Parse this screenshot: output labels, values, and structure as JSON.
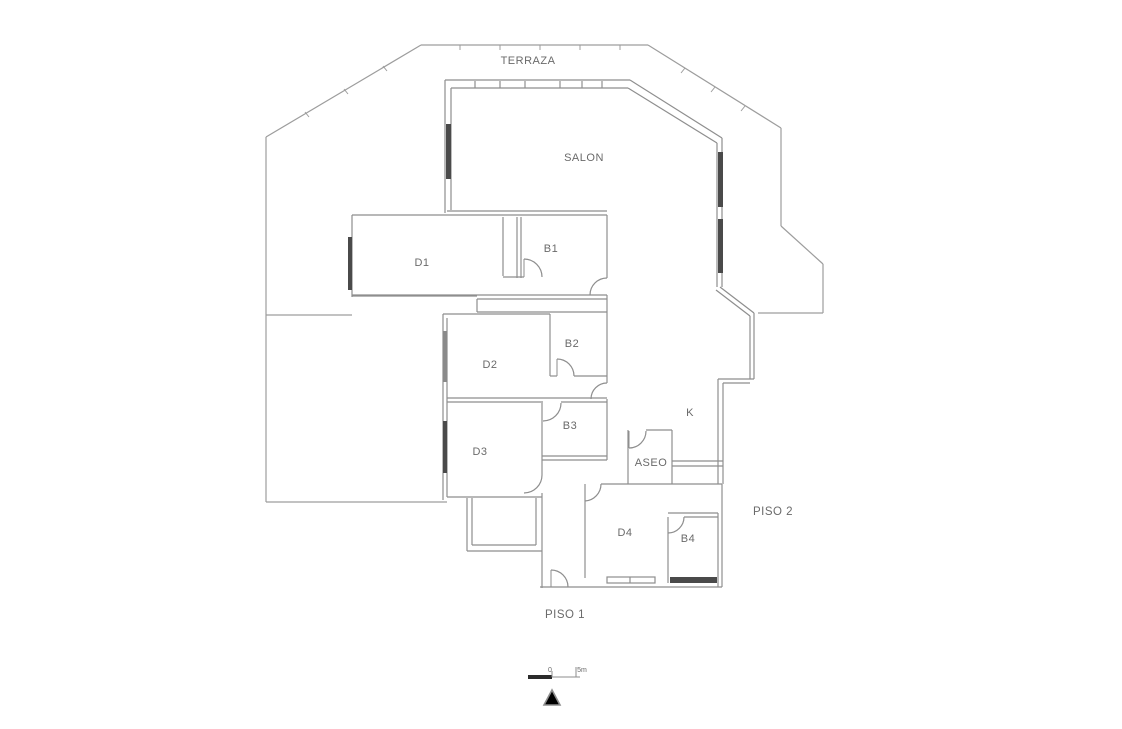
{
  "rooms": {
    "terraza": "TERRAZA",
    "salon": "SALON",
    "d1": "D1",
    "b1": "B1",
    "d2": "D2",
    "b2": "B2",
    "d3": "D3",
    "b3": "B3",
    "k": "K",
    "aseo": "ASEO",
    "d4": "D4",
    "b4": "B4"
  },
  "floors": {
    "piso1": "PISO 1",
    "piso2": "PISO 2"
  },
  "scale_bar": {
    "start_label": "0",
    "end_label": "5m"
  },
  "icons": {
    "north_arrow": "triangle-outline"
  },
  "colors": {
    "background": "#ffffff",
    "wall_line": "#8e8e8e",
    "terrace_line": "#9d9d9d",
    "window_fill": "#4a4a4a",
    "window_fill_light": "#8a8a8a",
    "scale_fill": "#2b2b2b",
    "text": "#6a6a6a"
  }
}
